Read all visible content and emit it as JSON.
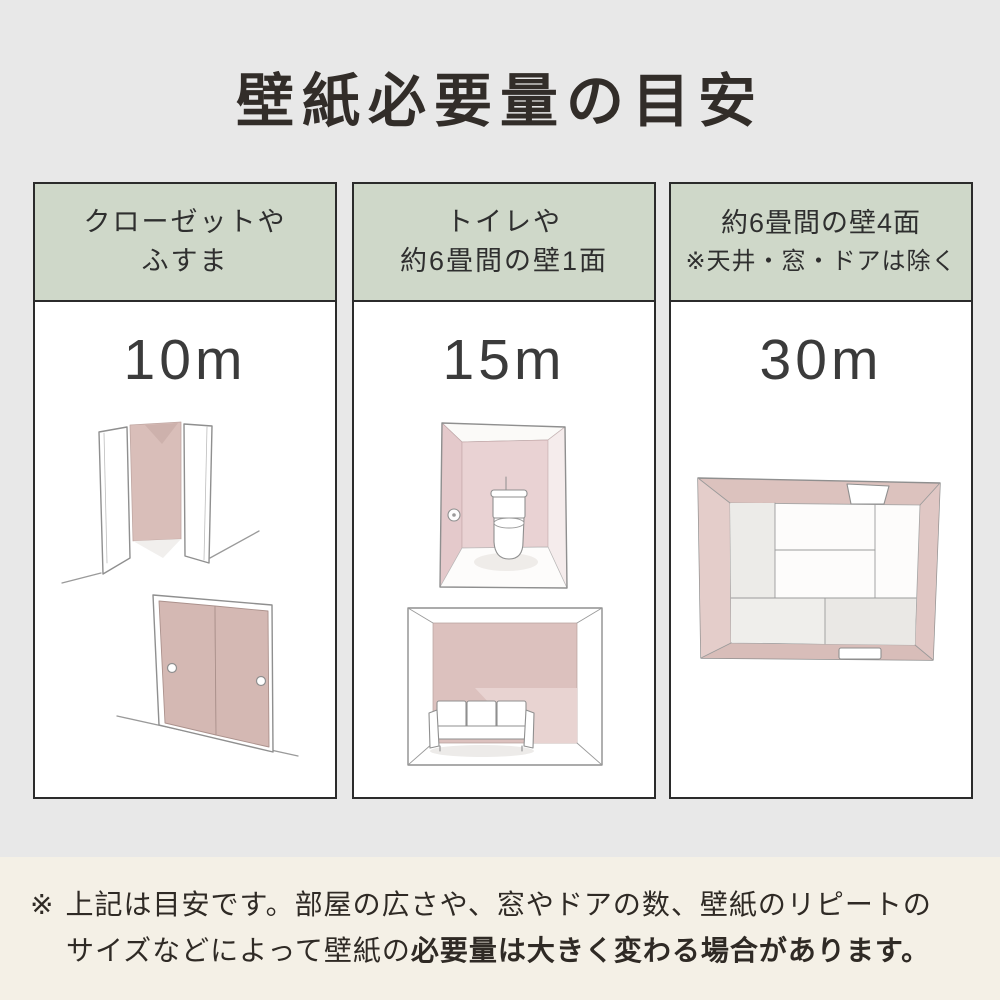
{
  "title": "壁紙必要量の目安",
  "columns": [
    {
      "header": {
        "line1": "クローゼットや",
        "line2": "ふすま"
      },
      "quantity": "10m",
      "illustrations": [
        "closet",
        "fusuma-sliding-doors"
      ]
    },
    {
      "header": {
        "line1": "トイレや",
        "line2": "約6畳間の壁1面"
      },
      "quantity": "15m",
      "illustrations": [
        "toilet-room",
        "six-tatami-room-one-wall"
      ]
    },
    {
      "header": {
        "line1": "約6畳間の壁4面",
        "line2": "※天井・窓・ドアは除く"
      },
      "quantity": "30m",
      "illustrations": [
        "six-tatami-room-top-view"
      ]
    }
  ],
  "footnote": {
    "marker": "※",
    "line1": "上記は目安です。部屋の広さや、窓やドアの数、壁紙のリピートの",
    "line2_regular": "サイズなどによって壁紙の",
    "line2_bold": "必要量は大きく変わる場合があります。"
  },
  "colors": {
    "page_background": "#e8e8e8",
    "column_background": "#ffffff",
    "header_background": "#cfd8c9",
    "column_border": "#2b2b2b",
    "wallpaper_pink": "#d8bcb7",
    "footnote_background": "#f4f0e6",
    "text": "#322d29"
  }
}
